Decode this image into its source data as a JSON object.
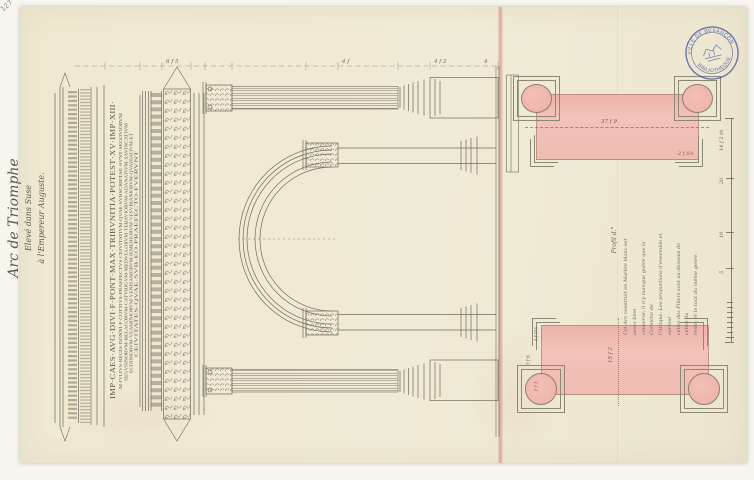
{
  "sheet": {
    "corner_number": "127",
    "title": {
      "line1": "Arc de Triomphe",
      "line2": "Elevé dans Suse",
      "line3": "à l'Empereur Auguste."
    },
    "inscription": {
      "line1": "IMP·CAES·AVG·DIVI·F·PONT·MAX·TRIBVNITIA·POTEST·XV·IMP·XIII·",
      "line2": "M·IVLIVS·REGIS·DONNI·F·COTTIVS·PRAEFECTVS·CEIVITATIVM·QVAE·SVBSCRIPTAE·SVNT·SEGOVIORVM",
      "line3": "SEGVSINORVM·BELACORVM·CATVRIGVM·MEDVLLORVM·TEBAVIORVM·ADANATIVM·SAVINCATIVM",
      "line4": "ECDINIORVM·VEAMINIORVM·VENISAMORVM·IEMERIORVM·VESVBIANIORVM·QVADIATIVM·ET",
      "line5": "CEIVITATES·QVAE·SVB·EO·PRAEFECTO·FVERVNT"
    },
    "elevation_dims": {
      "d1": "6 f 5",
      "d2": "4 f",
      "d3": "4 f 2",
      "d4": "4"
    },
    "plans": {
      "upper": {
        "center_dim": "37 f 9",
        "corner_dim": "2 f 6½"
      },
      "lower": {
        "center_dim": "15 f 2",
        "left_dims": {
          "d1": "4 f 5½",
          "d2": "3 f 6",
          "d3": "2 f 1"
        }
      },
      "label": "Profil d.°"
    },
    "note": {
      "line1": "Cet Arc construit en Marbre blanc est assez bien",
      "line2": "conservé; il n'y manque guère que la Corniche de",
      "line3": "l'Attique. Les proportions d'ensemble et surtout",
      "line4": "celles des Piliers sont au-dessous de celles du",
      "line5": "reste; et le tout du même genre."
    },
    "scale_bar": {
      "caption": "14 f 2 th",
      "t20": "20",
      "t10": "10",
      "t5": "5"
    },
    "stamp": {
      "top": "VILLE DE BESANÇON",
      "bottom": "BIBLIOTHÈQUE"
    }
  },
  "colors": {
    "paper": "#efe9d2",
    "ink": "#6f6b5d",
    "wash_pink": "#f1bdb4",
    "stamp_blue": "#4656a0",
    "fold_red": "#c0685c"
  }
}
